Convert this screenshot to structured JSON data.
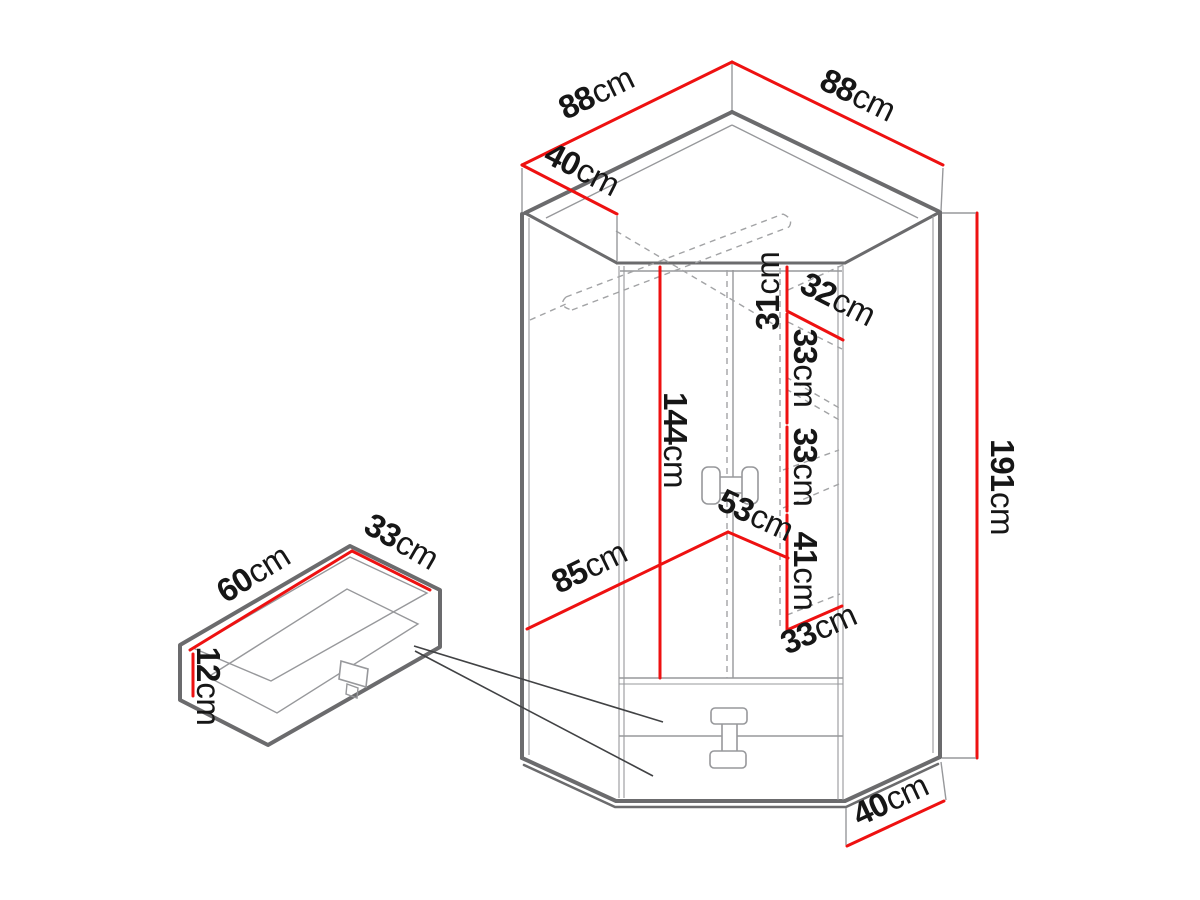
{
  "colors": {
    "background": "#ffffff",
    "red": "#ee1111",
    "outline": "#6b6b6d",
    "thin_line": "#97989b",
    "hidden_line": "#a2a3a5",
    "label": "#161616",
    "leader": "#414244"
  },
  "wardrobe": {
    "dims": {
      "top_edge_left": {
        "value": "88",
        "unit": "cm"
      },
      "top_edge_right": {
        "value": "88",
        "unit": "cm"
      },
      "side_depth_top": {
        "value": "40",
        "unit": "cm"
      },
      "total_height": {
        "value": "191",
        "unit": "cm"
      },
      "door_height": {
        "value": "144",
        "unit": "cm"
      },
      "top_shelf_gap": {
        "value": "31",
        "unit": "cm"
      },
      "shelf_depth": {
        "value": "32",
        "unit": "cm"
      },
      "shelf_gap_upper": {
        "value": "33",
        "unit": "cm"
      },
      "shelf_gap_middle": {
        "value": "33",
        "unit": "cm"
      },
      "shelf_gap_lower": {
        "value": "41",
        "unit": "cm"
      },
      "shelf_width": {
        "value": "33",
        "unit": "cm"
      },
      "front_left_width": {
        "value": "85",
        "unit": "cm"
      },
      "front_right_width": {
        "value": "53",
        "unit": "cm"
      },
      "side_depth_bottom": {
        "value": "40",
        "unit": "cm"
      }
    }
  },
  "drawer_detail": {
    "dims": {
      "width": {
        "value": "60",
        "unit": "cm"
      },
      "depth": {
        "value": "33",
        "unit": "cm"
      },
      "height": {
        "value": "12",
        "unit": "cm"
      }
    }
  }
}
